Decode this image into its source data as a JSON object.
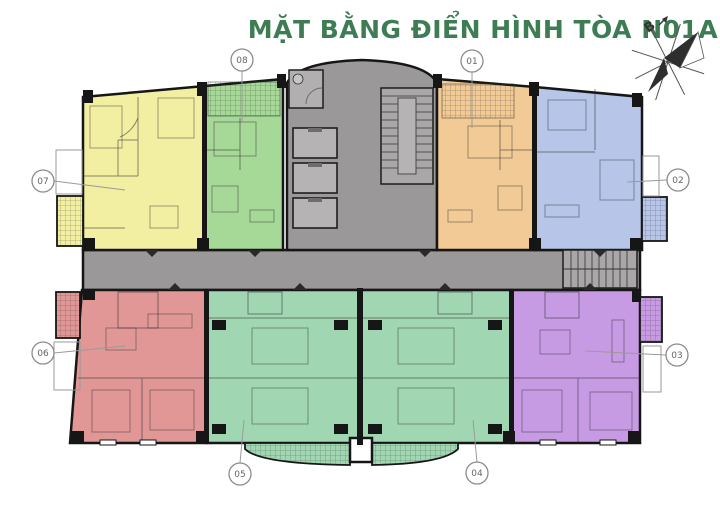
{
  "title": "MẶT BẰNG ĐIỂN HÌNH TÒA N01A",
  "colors": {
    "title": "#3e7d54",
    "core": "#9b989a",
    "core_room": "#b2afb1",
    "stair": "#aaa7a9",
    "elevator": "#b6b3b5",
    "walls": "#161616"
  },
  "compass": {
    "north_label": "B"
  },
  "apartments": [
    {
      "number": "01",
      "position": "top-right-center",
      "color": "#f2ca95"
    },
    {
      "number": "02",
      "position": "top-right",
      "color": "#b7c5e9"
    },
    {
      "number": "03",
      "position": "bottom-right",
      "color": "#c79be3"
    },
    {
      "number": "04",
      "position": "bottom-center-right",
      "color": "#a0d7b2"
    },
    {
      "number": "05",
      "position": "bottom-center-left",
      "color": "#a0d7b2"
    },
    {
      "number": "06",
      "position": "bottom-left",
      "color": "#e09796"
    },
    {
      "number": "07",
      "position": "top-left",
      "color": "#f2efa2"
    },
    {
      "number": "08",
      "position": "top-left-center",
      "color": "#a6d897"
    }
  ]
}
